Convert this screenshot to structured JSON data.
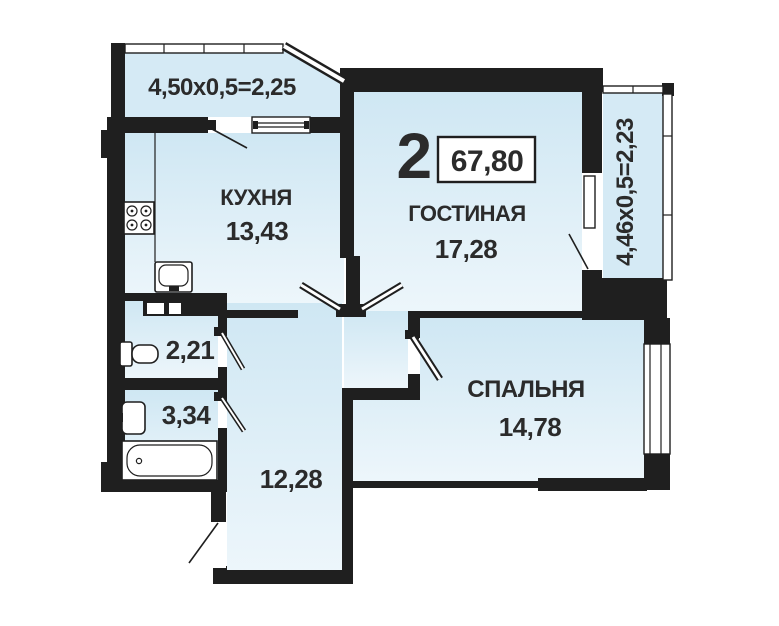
{
  "plan": {
    "rooms_count": "2",
    "total_area": "67,80",
    "labels": {
      "kitchen_name": "КУХНЯ",
      "kitchen_area": "13,43",
      "living_name": "ГОСТИНАЯ",
      "living_area": "17,28",
      "bedroom_name": "СПАЛЬНЯ",
      "bedroom_area": "14,78",
      "wc_area": "2,21",
      "bathroom_area": "3,34",
      "hallway_area": "12,28",
      "balcony_top_dim": "4,50x0,5=2,25",
      "balcony_right_dim": "4,46x0,5=2,23"
    },
    "colors": {
      "wall": "#1f1f1f",
      "text": "#2b2b2b",
      "background": "#ffffff",
      "balcony_fill": "#d5eaf5",
      "room_fill_top": "#cfe7f3",
      "room_fill_bottom": "#edf6fb"
    },
    "fixtures": [
      {
        "icon": "stove-icon"
      },
      {
        "icon": "kitchen-sink-icon"
      },
      {
        "icon": "toilet-icon"
      },
      {
        "icon": "washbasin-icon"
      },
      {
        "icon": "bathtub-icon"
      }
    ]
  }
}
